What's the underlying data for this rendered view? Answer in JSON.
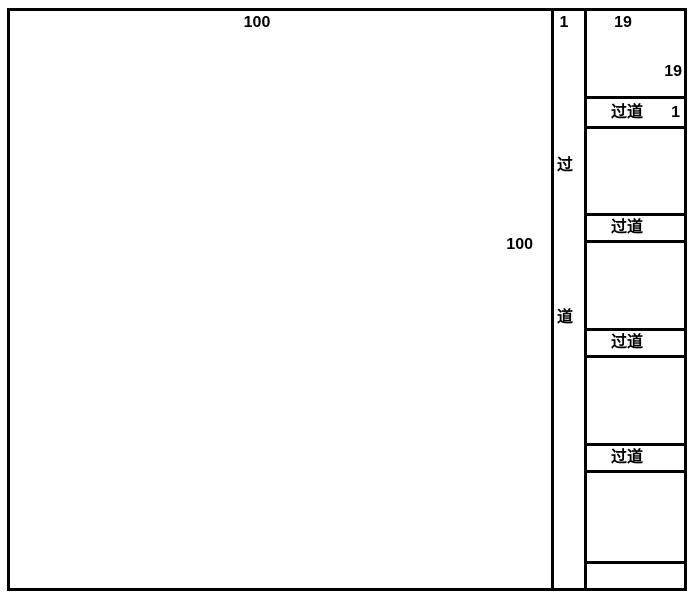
{
  "main_area": {
    "top_label": "100",
    "right_label": "100"
  },
  "center_aisle": {
    "top_label": "1",
    "char_top": "过",
    "char_bottom": "道"
  },
  "right_wing": {
    "top_room": {
      "label_top": "19",
      "label_right": "19"
    },
    "aisle_1": {
      "label": "过道",
      "width_label": "1"
    },
    "aisle_2": {
      "label": "过道"
    },
    "aisle_3": {
      "label": "过道"
    },
    "aisle_4": {
      "label": "过道"
    }
  },
  "colors": {
    "line": "#000000",
    "background": "#ffffff"
  }
}
